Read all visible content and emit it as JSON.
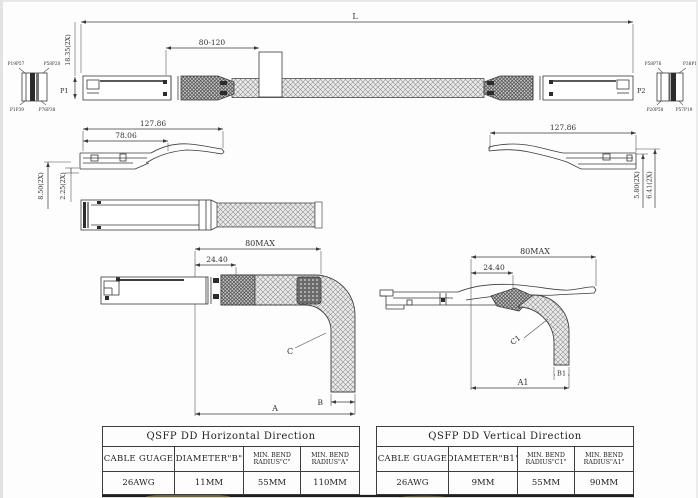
{
  "top_view": {
    "dim_overall": "L",
    "dim_height": "18.35(2X)",
    "dim_label_range": "80-120",
    "p1_label": "P1",
    "p2_label": "P2",
    "p1_pins": {
      "top_left": "P19P57",
      "top_right": "P58P20",
      "bottom_left": "P1P39",
      "bottom_right": "P76P38"
    },
    "p2_pins": {
      "top_left": "P58P76",
      "top_right": "P38P1",
      "bottom_left": "P20P58",
      "bottom_right": "P57P19"
    }
  },
  "side_view_left": {
    "dim_total": "127.86",
    "dim_front": "78.06",
    "dim_v1": "8.50(2X)",
    "dim_v2": "2.25(2X)"
  },
  "side_view_right": {
    "dim_total": "127.86",
    "dim_v1": "5.80(2X)",
    "dim_v2": "6.41(2X)"
  },
  "bend_horizontal": {
    "dim_max": "80MAX",
    "dim_offset": "24.40",
    "label_c": "C",
    "label_b": "B",
    "label_a": "A"
  },
  "bend_vertical": {
    "dim_max": "80MAX",
    "dim_offset": "24.40",
    "label_c": "C1",
    "label_b": "B1",
    "label_a": "A1"
  },
  "tables": {
    "horizontal": {
      "title": "QSFP DD Horizontal Direction",
      "col1": "CABLE GUAGE",
      "col2": "DIAMETER\"B\"",
      "col3a": "MIN. BEND",
      "col3b": "RADIUS\"C\"",
      "col4a": "MIN. BEND",
      "col4b": "RADIUS\"A\"",
      "val1": "26AWG",
      "val2": "11MM",
      "val3": "55MM",
      "val4": "110MM"
    },
    "vertical": {
      "title": "QSFP DD Vertical Direction",
      "col1": "CABLE GUAGE",
      "col2": "DIAMETER\"B1\"",
      "col3a": "MIN. BEND",
      "col3b": "RADIUS\"C1\"",
      "col4a": "MIN. BEND",
      "col4b": "RADIUS\"A1\"",
      "val1": "26AWG",
      "val2": "9MM",
      "val3": "55MM",
      "val4": "90MM"
    }
  },
  "colors": {
    "line": "#3a3a3a",
    "braid_hatch": "#8f8f8f",
    "emi_hatch": "#4c4c4c",
    "dark_fill": "#2c2c2c",
    "heavy_rule": "#1e1e1e"
  }
}
